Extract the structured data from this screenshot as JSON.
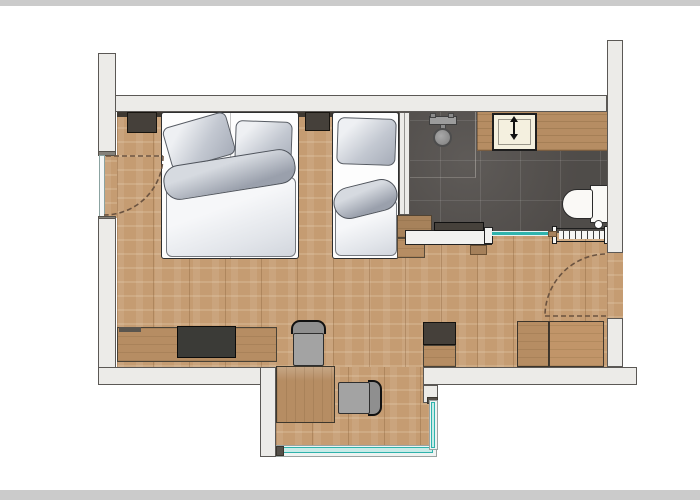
{
  "meta": {
    "kind": "architectural-floor-plan",
    "view": "top-down",
    "content": "hotel room floor plan with bedroom-living area, bathroom and window bay"
  },
  "palette": {
    "frame_strip": "#cbcbcb",
    "wall_fill": "#ecebe8",
    "wall_outline": "#5b5855",
    "floor_wood": "#c59c72",
    "tile": "#56524f",
    "furniture_wood": "#b68d63",
    "glass": "#2fb3ac",
    "glass_fill": "#c8ebe8",
    "headboard": "#3e3831",
    "cabinet_dark": "#45403a",
    "chair_gray": "#a3a3a3",
    "tv_dark": "#3b3b37",
    "door_arc": "#6b5340",
    "fixture_white": "#faf9f6",
    "sink_cream": "#f4f0df",
    "shower_metal": "#9c9c9c"
  },
  "rooms": [
    {
      "name": "bedroom-living-area",
      "floor": "wood-plank"
    },
    {
      "name": "bathroom",
      "floor": "dark-tile"
    },
    {
      "name": "window-bay",
      "floor": "wood-plank"
    }
  ],
  "furniture": [
    "headboard-panel",
    "nightstand-left",
    "nightstand-center",
    "double-bed",
    "single-bed",
    "pillows",
    "duvets",
    "sideboard",
    "tv-on-sideboard",
    "desk-table",
    "chair-top",
    "chair-right",
    "minibar-cabinet",
    "wardrobe-unit-1",
    "wardrobe-unit-2",
    "bench-with-cushion",
    "step-stool"
  ],
  "fixtures": [
    "shower-head",
    "shower-mixer-bar",
    "vanity-counter",
    "washbasin",
    "toilet",
    "towel-radiator",
    "glass-partition"
  ],
  "openings": [
    {
      "name": "left-door",
      "type": "hinged-door-dashed-swing",
      "wall": "left"
    },
    {
      "name": "entry-door",
      "type": "hinged-door-dashed-swing",
      "wall": "right"
    },
    {
      "name": "bay-window-bottom",
      "type": "glazing"
    },
    {
      "name": "bay-window-right",
      "type": "glazing"
    }
  ]
}
